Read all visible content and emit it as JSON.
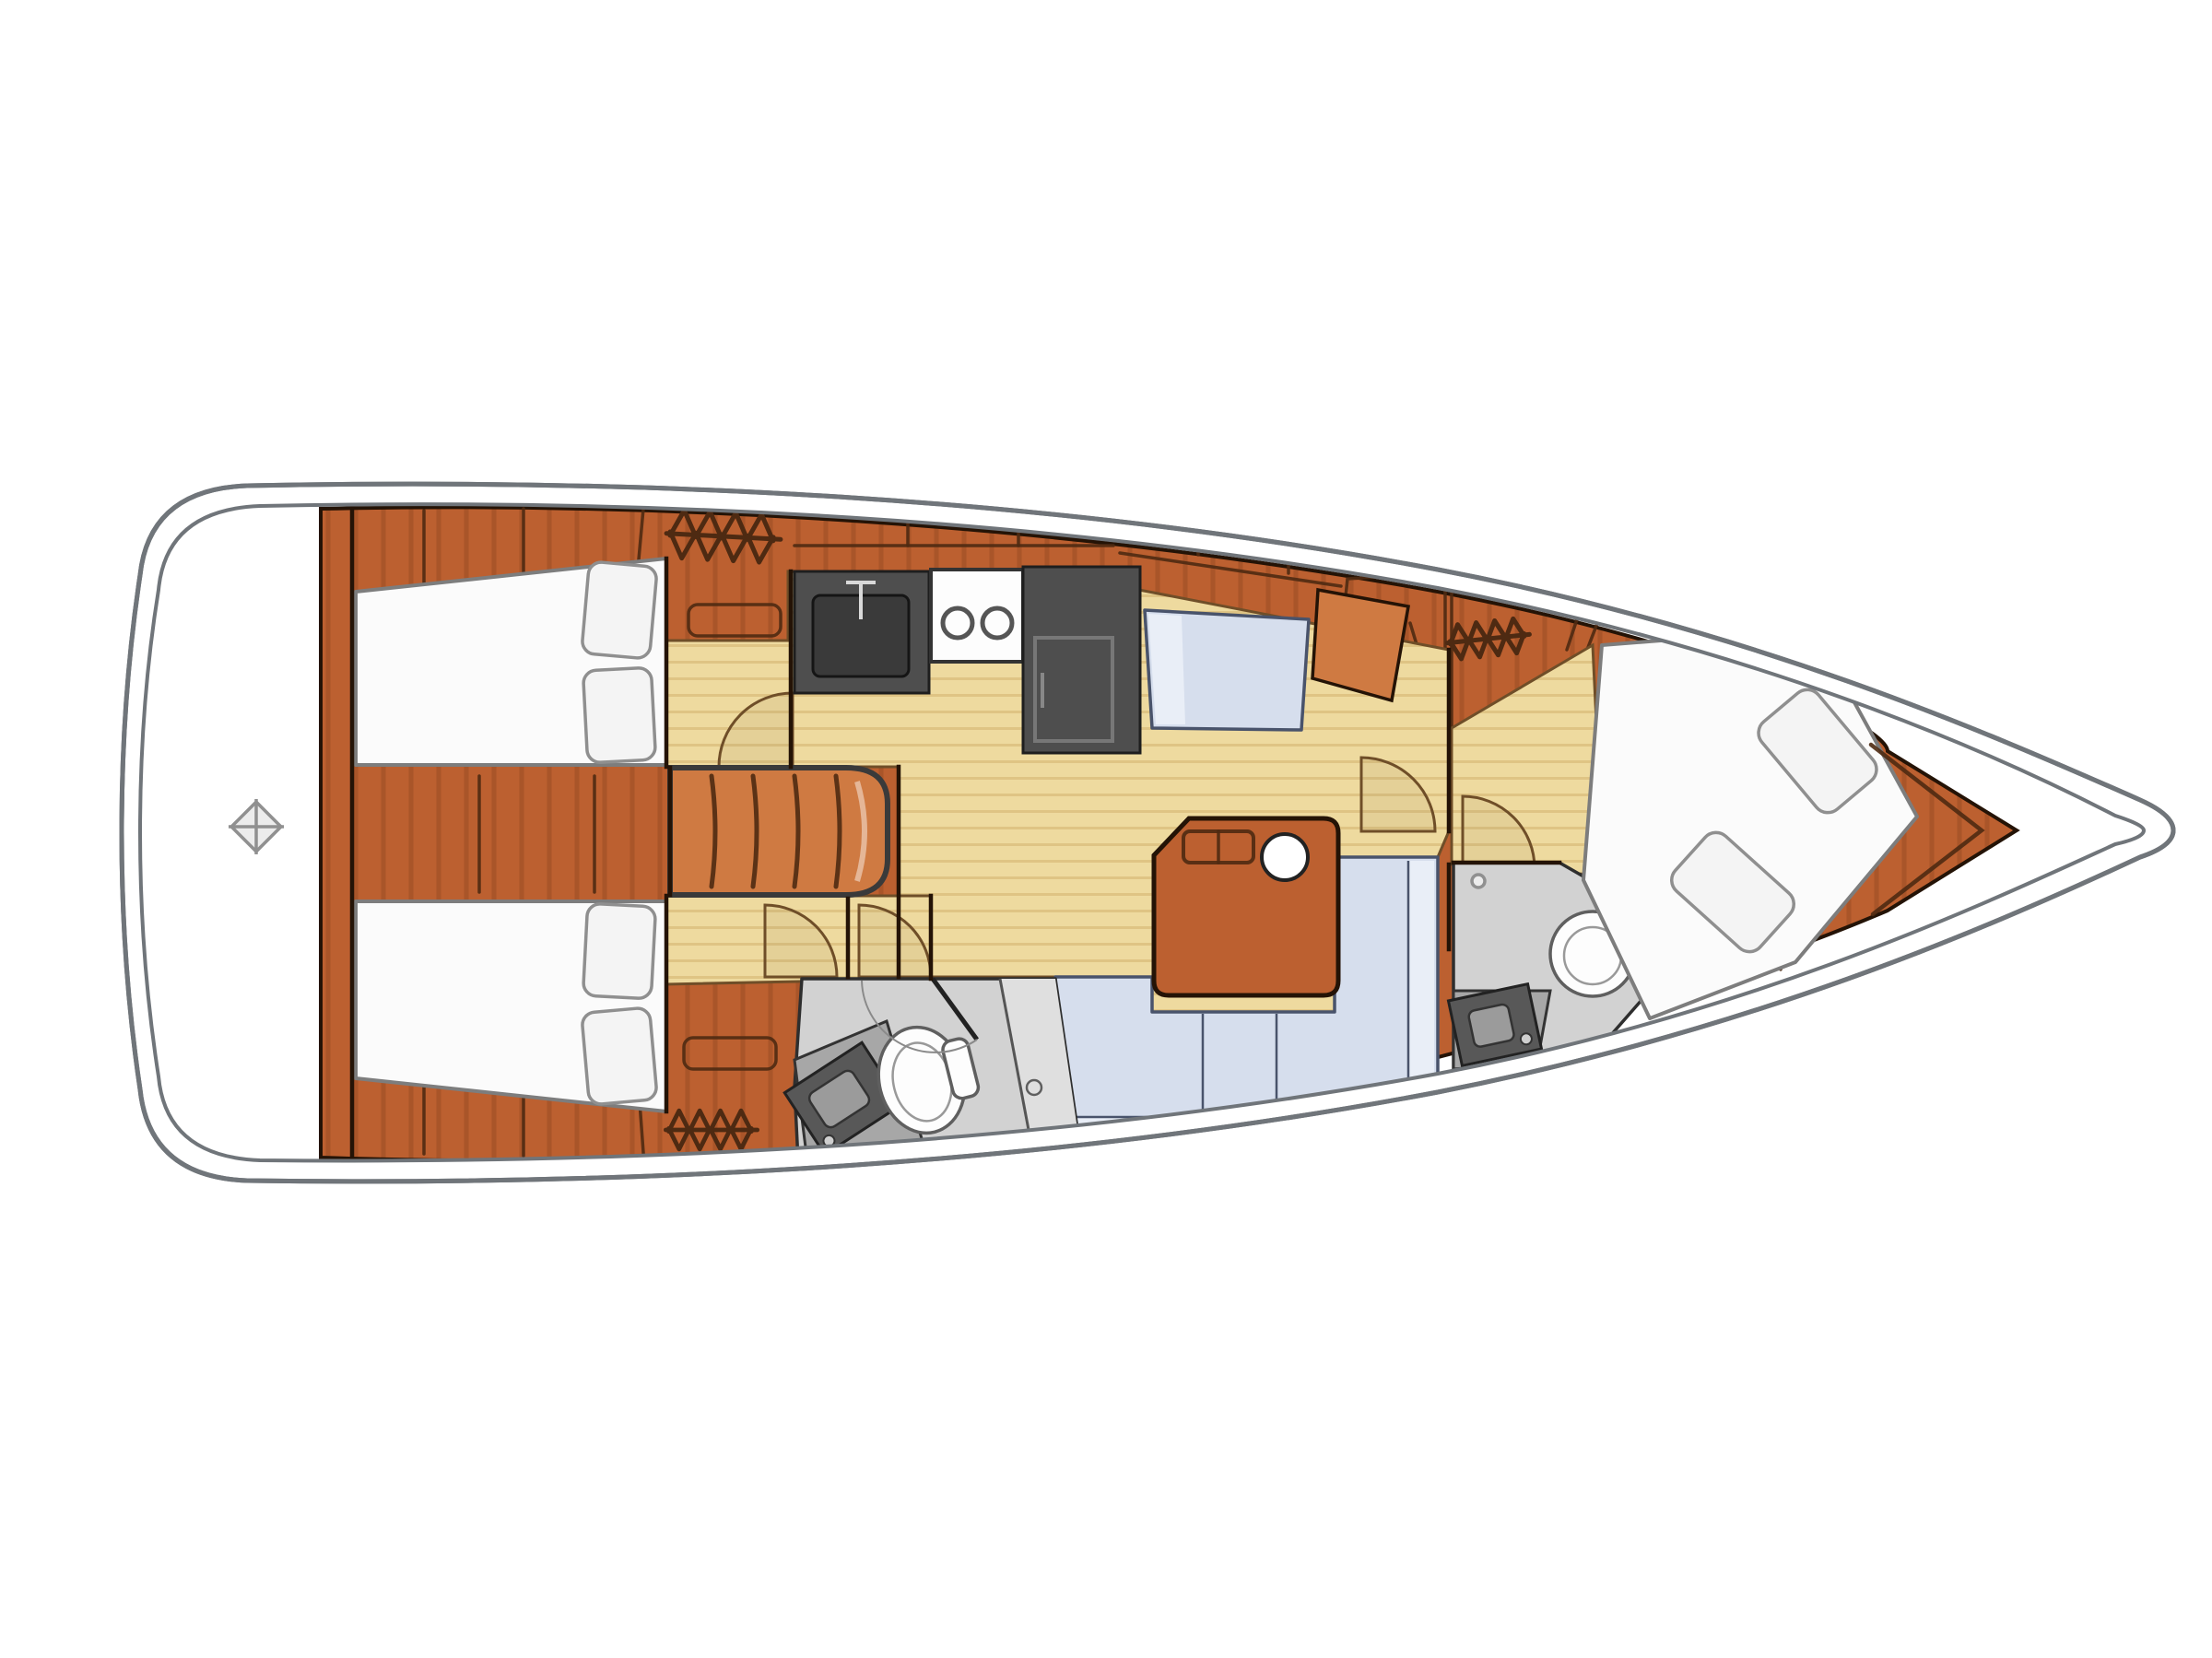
{
  "diagram": {
    "title": "Sailing yacht interior layout plan — top view, bow to the right",
    "type": "yacht-floor-plan",
    "orientation": {
      "bow": "right",
      "stern": "left"
    }
  },
  "colors": {
    "background": "#ffffff",
    "hull_line": "#70757a",
    "outline": "#241306",
    "wood": "#bc6030",
    "wood_dark": "#9f4d1e",
    "wood_light": "#cf7a42",
    "seam": "#4e2a12",
    "floor": "#eeda9f",
    "floor_stripe": "#dfc484",
    "floor_line": "#6f4e28",
    "bed_white": "#fbfbfb",
    "bed_stroke": "#7d7d7d",
    "pillow": "#f4f4f4",
    "pillow_stroke": "#8f8f8f",
    "blue": "#d6deed",
    "blue_light": "#e9eef7",
    "blue_stroke": "#49536b",
    "gray_floor": "#d2d2d2",
    "gray_light": "#dfdfdf",
    "gray_counter": "#a7a7a7",
    "gray_dark": "#4e4e4e",
    "gray_mid": "#909090",
    "fixture_white": "#fdfdfd",
    "fixture_stroke": "#5f5f5f"
  },
  "compartments": [
    {
      "id": "transom",
      "label": "stern cockpit / transom",
      "fixtures": [
        "compass marker"
      ]
    },
    {
      "id": "aft-cabin-port",
      "label": "aft double cabin, port",
      "fixtures": [
        "double berth",
        "2 pillows",
        "side locker with shelf",
        "opening hatch",
        "door"
      ]
    },
    {
      "id": "aft-cabin-starboard",
      "label": "aft double cabin, starboard",
      "fixtures": [
        "double berth",
        "2 pillows",
        "side locker with shelf",
        "opening hatch",
        "door"
      ]
    },
    {
      "id": "companionway",
      "label": "companionway steps",
      "step_count": 5
    },
    {
      "id": "galley",
      "label": "galley",
      "fixtures": [
        "sink with faucet",
        "2-burner stove",
        "refrigerator"
      ]
    },
    {
      "id": "nav-station",
      "label": "navigation station",
      "fixtures": [
        "seat",
        "chart table"
      ]
    },
    {
      "id": "saloon",
      "label": "saloon",
      "fixtures": [
        "C-shaped settee",
        "folding table",
        "cup holder"
      ]
    },
    {
      "id": "aft-head",
      "label": "aft head",
      "fixtures": [
        "toilet",
        "washbasin",
        "shower stall",
        "door"
      ]
    },
    {
      "id": "forward-head",
      "label": "forward head",
      "fixtures": [
        "toilet",
        "washbasin",
        "door"
      ]
    },
    {
      "id": "forward-cabin",
      "label": "forward double V-berth cabin",
      "fixtures": [
        "double berth",
        "2 pillows",
        "dresser",
        "opening hatch",
        "door"
      ]
    }
  ],
  "symbols": {
    "hatch_count": 3,
    "door_arc_count": 6,
    "compass_marker_count": 1
  }
}
